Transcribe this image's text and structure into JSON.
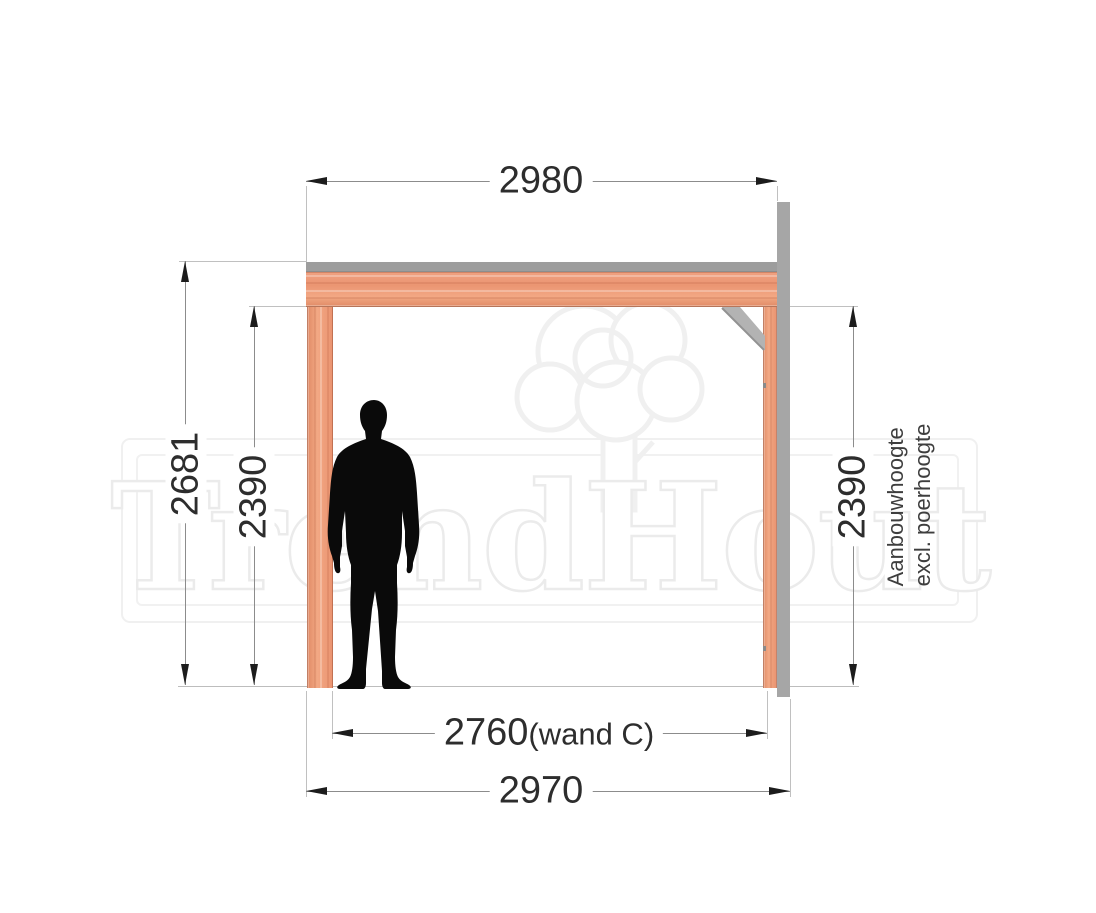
{
  "watermark": {
    "text": "TrendHout"
  },
  "dims": {
    "top_width": "2980",
    "outer_height": "2681",
    "left_inner_height": "2390",
    "right_inner_height": "2390",
    "inner_width_value": "2760",
    "inner_width_suffix": "(wand C)",
    "outer_width": "2970"
  },
  "side_label": {
    "line1": "Aanbouwhoogte",
    "line2": "excl. poerhoogte"
  },
  "colors": {
    "wood_base": "#ED9C7A",
    "wood_light": "#F6B797",
    "wood_dark": "#E18766",
    "metal_gray": "#A6A6A6",
    "cap_gray": "#9D9D9D",
    "dim_line": "#8C8C8C",
    "extension_line": "#C0C0C0",
    "arrow_black": "#1C1C1C",
    "dim_text": "#2D2D2D",
    "watermark_gray": "#EDEDED",
    "silhouette_black": "#0A0A0A"
  }
}
